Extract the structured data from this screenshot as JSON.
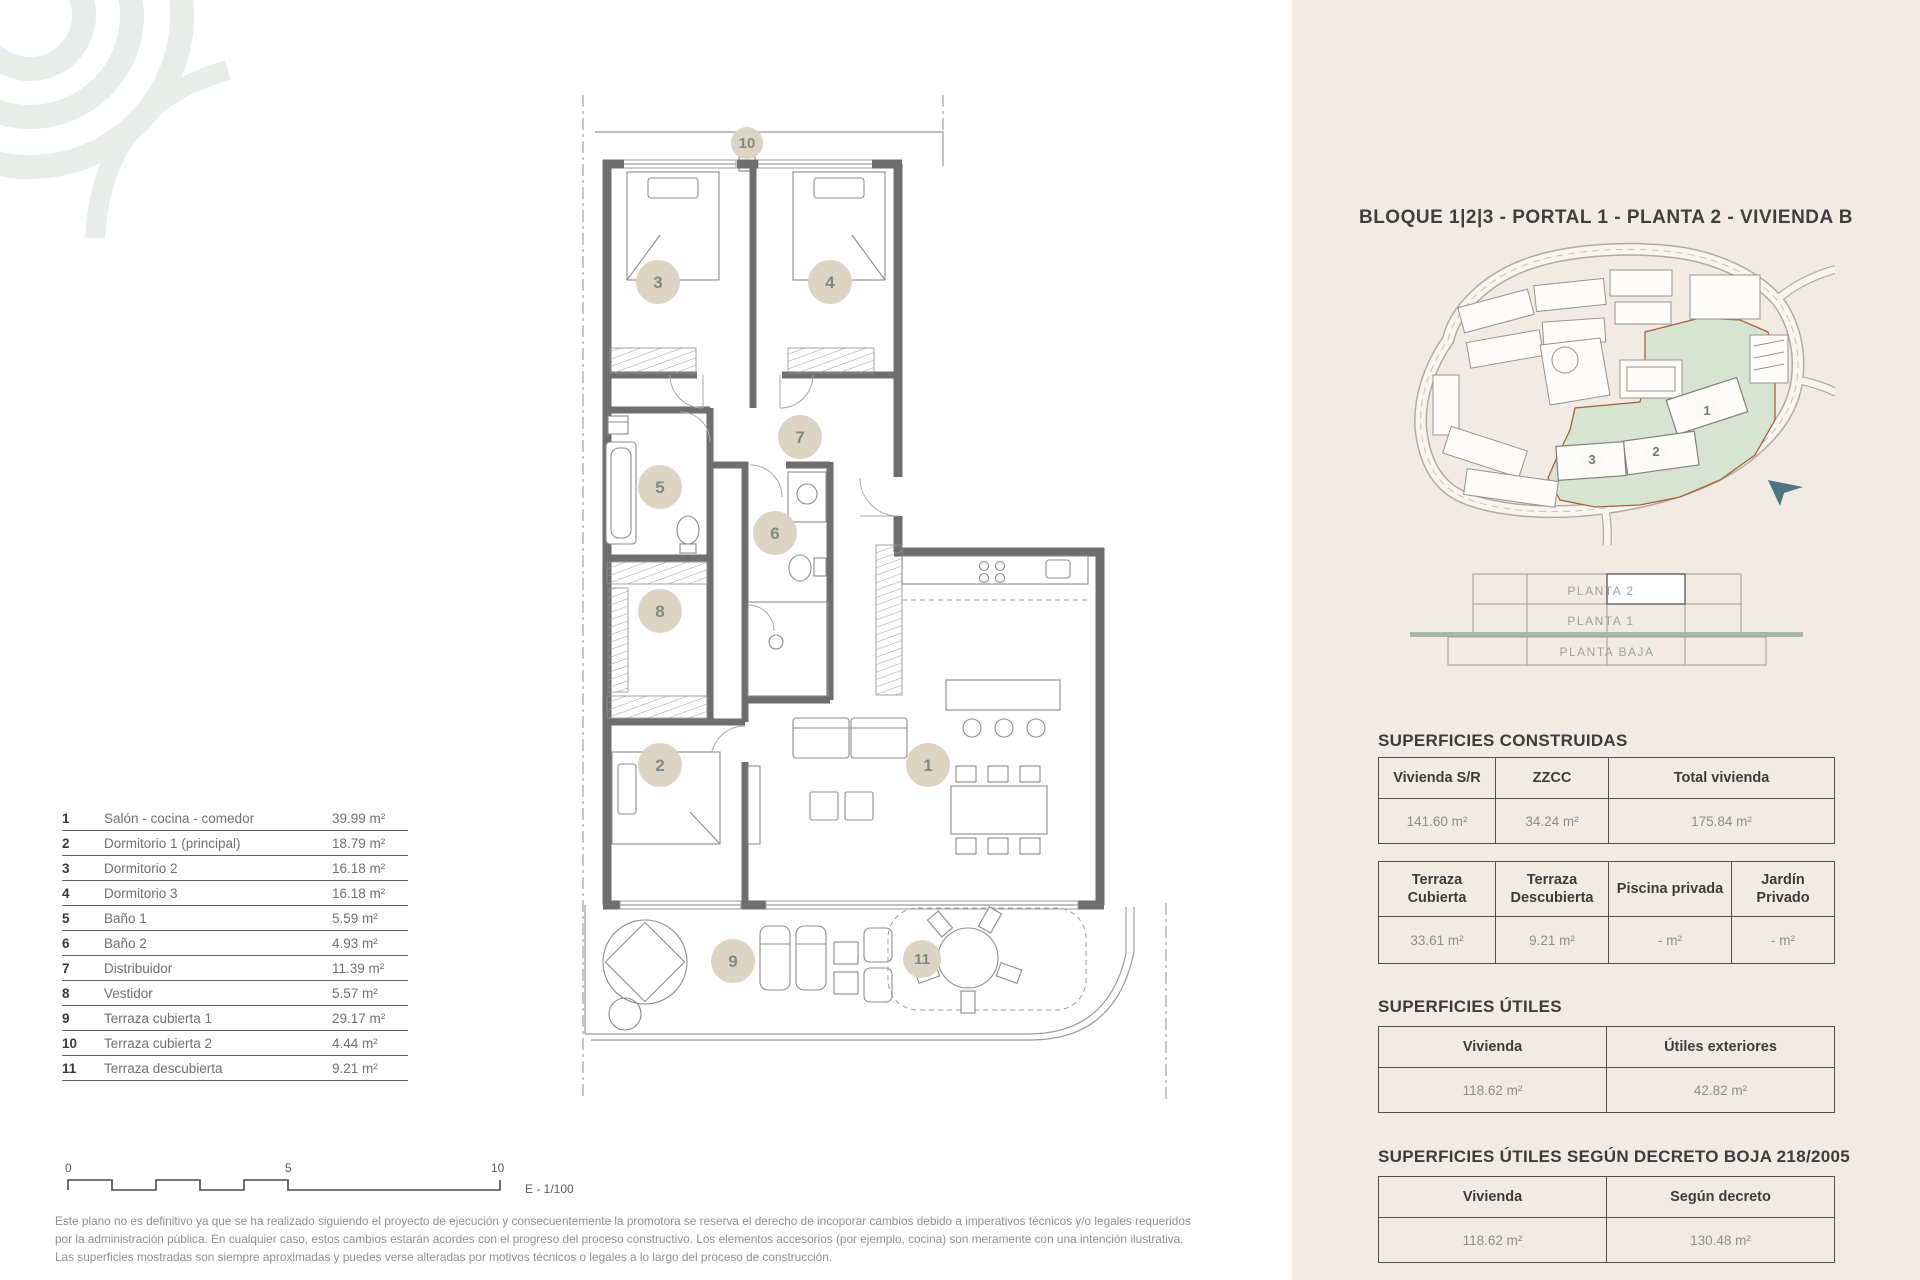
{
  "header": {
    "title": "BLOQUE 1|2|3 - PORTAL 1 - PLANTA 2 - VIVIENDA B"
  },
  "plan": {
    "rooms": [
      "1",
      "2",
      "3",
      "4",
      "5",
      "6",
      "7",
      "8",
      "9",
      "10",
      "11"
    ]
  },
  "legend": {
    "rows": [
      {
        "num": "1",
        "name": "Salón - cocina - comedor",
        "area": "39.99 m²"
      },
      {
        "num": "2",
        "name": "Dormitorio 1 (principal)",
        "area": "18.79 m²"
      },
      {
        "num": "3",
        "name": "Dormitorio 2",
        "area": "16.18 m²"
      },
      {
        "num": "4",
        "name": "Dormitorio 3",
        "area": "16.18 m²"
      },
      {
        "num": "5",
        "name": "Baño 1",
        "area": "5.59 m²"
      },
      {
        "num": "6",
        "name": "Baño 2",
        "area": "4.93 m²"
      },
      {
        "num": "7",
        "name": "Distribuidor",
        "area": "11.39 m²"
      },
      {
        "num": "8",
        "name": "Vestidor",
        "area": "5.57 m²"
      },
      {
        "num": "9",
        "name": "Terraza cubierta 1",
        "area": "29.17 m²"
      },
      {
        "num": "10",
        "name": "Terraza cubierta 2",
        "area": "4.44 m²"
      },
      {
        "num": "11",
        "name": "Terraza descubierta",
        "area": "9.21 m²"
      }
    ]
  },
  "scale": {
    "t0": "0",
    "t5": "5",
    "t10": "10",
    "ratio": "E - 1/100"
  },
  "disclaimer": {
    "l1": "Este plano no es definitivo ya que se ha realizado siguiendo el proyecto de ejecución y consecuentemente la promotora se reserva el derecho de incoporar cambios debido a imperativos técnicos y/o legales requeridos",
    "l2": "por la administración pública. En cualquier caso, estos cambios estarán acordes con el progreso del proceso constructivo. Los elementos accesorios (por ejemplo, cocina) son meramente con una intención ilustrativa.",
    "l3": "Las superficies mostradas son siempre aproximadas y puedes verse alteradas por motivos técnicos o legales a lo largo del proceso de construcción."
  },
  "site_plan": {
    "blocks": [
      "1",
      "2",
      "3"
    ]
  },
  "elevation": {
    "floors": [
      "PLANTA 2",
      "PLANTA 1",
      "PLANTA BAJA"
    ]
  },
  "s_construidas": {
    "heading": "SUPERFICIES CONSTRUIDAS",
    "table_principal": {
      "headers": [
        "Vivienda S/R",
        "ZZCC",
        "Total vivienda"
      ],
      "values": [
        "141.60 m²",
        "34.24 m²",
        "175.84 m²"
      ]
    },
    "table_exterior": {
      "headers": [
        "Terraza Cubierta",
        "Terraza Descubierta",
        "Piscina privada",
        "Jardín Privado"
      ],
      "values": [
        "33.61 m²",
        "9.21 m²",
        "- m²",
        "- m²"
      ]
    }
  },
  "s_utiles": {
    "heading": "SUPERFICIES ÚTILES",
    "table": {
      "headers": [
        "Vivienda",
        "Útiles exteriores"
      ],
      "values": [
        "118.62 m²",
        "42.82 m²"
      ]
    }
  },
  "s_decreto": {
    "heading": "SUPERFICIES ÚTILES SEGÚN DECRETO BOJA 218/2005",
    "table": {
      "headers": [
        "Vivienda",
        "Según decreto"
      ],
      "values": [
        "118.62 m²",
        "130.48 m²"
      ]
    }
  },
  "colors": {
    "accent_green": "#d6e4d1",
    "boundary_red": "#a8613f",
    "arrow_teal": "#4d7582",
    "room_badge": "#dcd2c1",
    "panel_bg": "#f1ebe4"
  }
}
